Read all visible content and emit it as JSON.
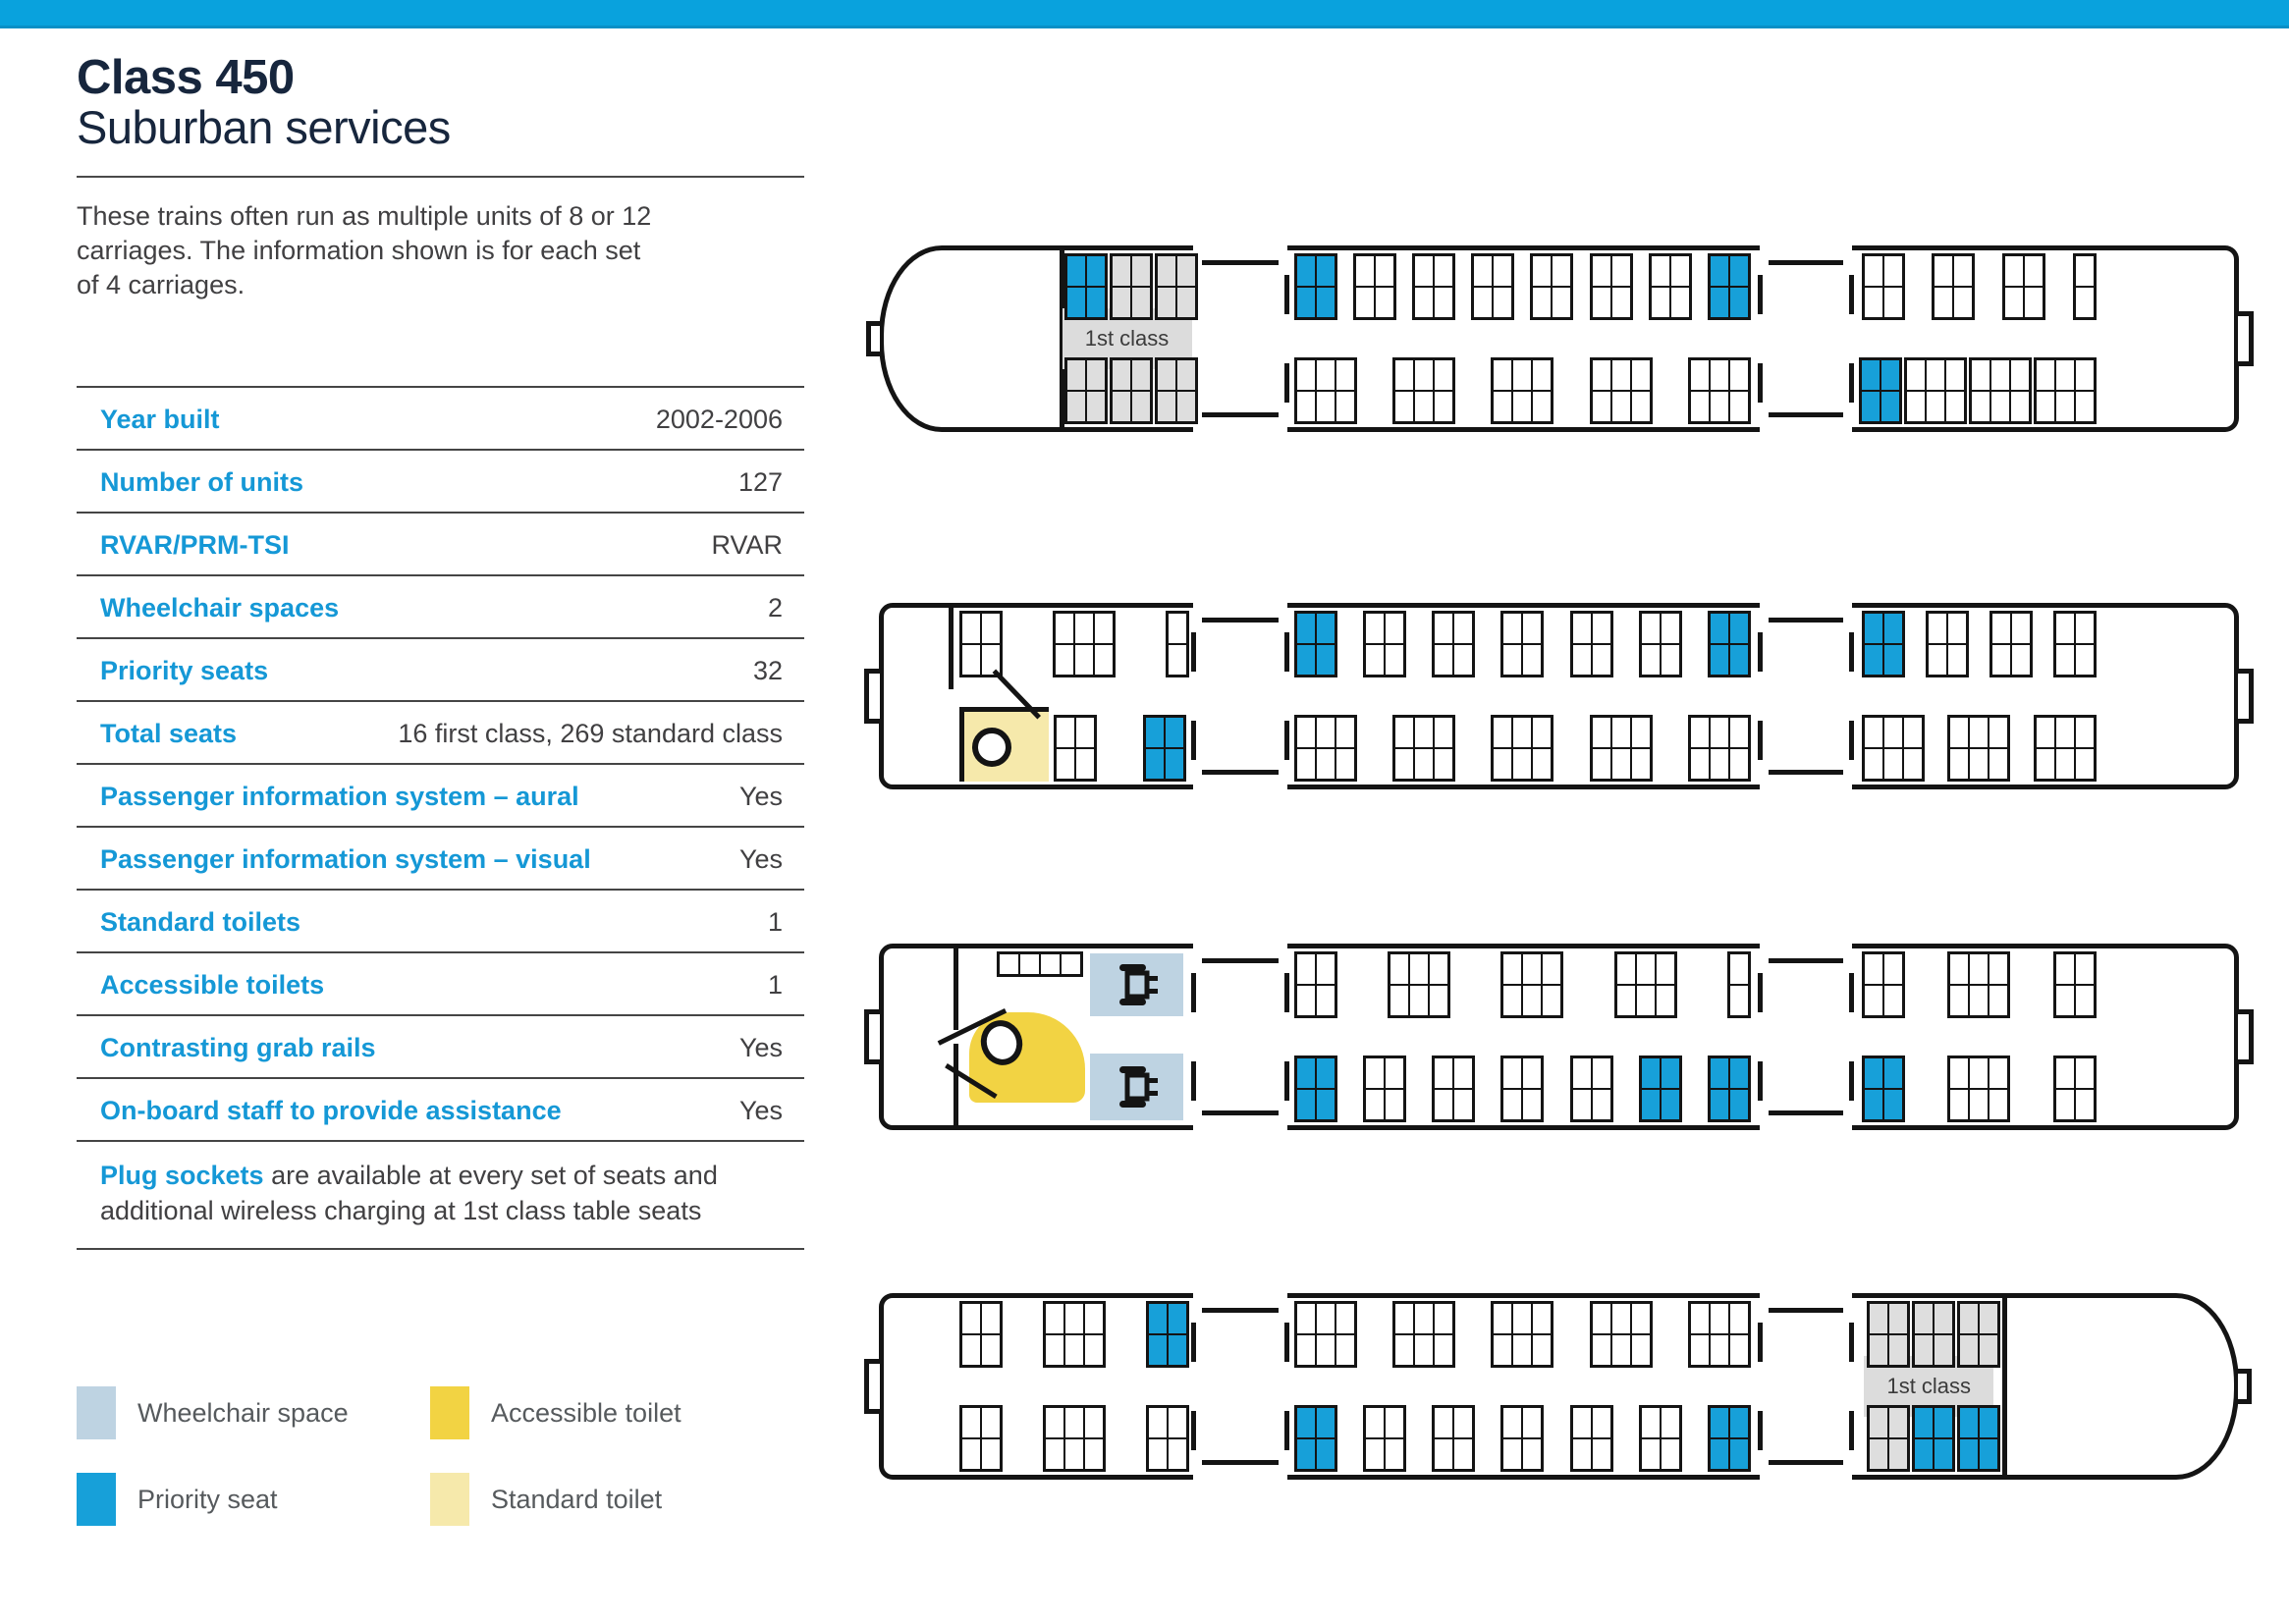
{
  "page": {
    "title_line1": "Class 450",
    "title_line2": "Suburban services",
    "intro": "These trains often run as multiple units of 8 or 12\ncarriages. The information shown is for each set\nof 4 carriages."
  },
  "table": {
    "rows": [
      {
        "label": "Year built",
        "value": "2002-2006"
      },
      {
        "label": "Number of units",
        "value": "127"
      },
      {
        "label": "RVAR/PRM-TSI",
        "value": "RVAR"
      },
      {
        "label": "Wheelchair spaces",
        "value": "2"
      },
      {
        "label": "Priority seats",
        "value": "32"
      },
      {
        "label": "Total seats",
        "value": "16 first class, 269 standard class"
      },
      {
        "label": "Passenger information system – aural",
        "value": "Yes"
      },
      {
        "label": "Passenger information system – visual",
        "value": "Yes"
      },
      {
        "label": "Standard toilets",
        "value": "1"
      },
      {
        "label": "Accessible toilets",
        "value": "1"
      },
      {
        "label": "Contrasting grab rails",
        "value": "Yes"
      },
      {
        "label": "On-board staff to provide assistance",
        "value": "Yes"
      }
    ],
    "note_lead": "Plug sockets",
    "note_rest": " are available at every set of seats and additional wireless charging at 1st class table seats"
  },
  "legend": [
    {
      "id": "wheelchair-space",
      "label": "Wheelchair space",
      "color": "#bed3e2"
    },
    {
      "id": "priority-seat",
      "label": "Priority seat",
      "color": "#17a0d9"
    },
    {
      "id": "accessible-toilet",
      "label": "Accessible toilet",
      "color": "#f2d343"
    },
    {
      "id": "standard-toilet",
      "label": "Standard toilet",
      "color": "#f6e9ab"
    }
  ],
  "colors": {
    "top_bar": "#09a2dd",
    "accent_cyan": "#1598d6",
    "title_navy": "#17263d",
    "priority_seat": "#17a0d9",
    "wheelchair_space": "#bed3e2",
    "accessible_toilet": "#f2d343",
    "standard_toilet": "#f6e9ab",
    "first_class_seat": "#dedede",
    "outline": "#141414"
  },
  "carriages": [
    {
      "name": "carriage-1",
      "cab": "left",
      "gangways": [
        "right"
      ],
      "label": {
        "text": "1st class",
        "x": 13.2,
        "w": 9.6
      },
      "walls": [
        {
          "x": 13.0,
          "span": "full"
        }
      ],
      "doors": [
        {
          "x": 22.9,
          "w": 7.0
        },
        {
          "x": 64.9,
          "w": 6.8
        }
      ],
      "bays": [
        {
          "row": "top",
          "x": 13.4,
          "x1": 22.6,
          "blocks": [
            "pri",
            "fc",
            "fc"
          ]
        },
        {
          "row": "top",
          "x": 30.4,
          "x1": 64.2,
          "blocks": [
            "pri",
            "std",
            "std",
            "std",
            "std",
            "std",
            "std",
            "pri"
          ]
        },
        {
          "row": "top",
          "x": 72.4,
          "x1": 89.8,
          "blocks": [
            "std",
            "std",
            "std",
            "std1"
          ]
        },
        {
          "row": "bottom",
          "x": 13.4,
          "x1": 22.6,
          "blocks": [
            "fc",
            "fc",
            "fc"
          ]
        },
        {
          "row": "bottom",
          "x": 30.4,
          "x1": 64.2,
          "blocks": [
            "std3",
            "std3",
            "std3",
            "std3",
            "std3"
          ]
        },
        {
          "row": "bottom",
          "x": 72.2,
          "x1": 89.8,
          "blocks": [
            "pri",
            "std3",
            "std3",
            "std3"
          ]
        }
      ],
      "features": []
    },
    {
      "name": "carriage-2",
      "cab": null,
      "gangways": [
        "left",
        "right"
      ],
      "label": null,
      "walls": [
        {
          "x": 4.8,
          "span": "top"
        }
      ],
      "doors": [
        {
          "x": 22.9,
          "w": 7.0
        },
        {
          "x": 64.9,
          "w": 6.8
        }
      ],
      "bays": [
        {
          "row": "top",
          "x": 5.6,
          "x1": 22.6,
          "blocks": [
            "std",
            "std3",
            "std1"
          ]
        },
        {
          "row": "top",
          "x": 30.4,
          "x1": 64.2,
          "blocks": [
            "pri",
            "std",
            "std",
            "std",
            "std",
            "std",
            "pri"
          ]
        },
        {
          "row": "top",
          "x": 72.4,
          "x1": 89.8,
          "blocks": [
            "pri",
            "std",
            "std",
            "std"
          ]
        },
        {
          "row": "bottom",
          "x": 12.6,
          "x1": 16.0,
          "blocks": [
            "std"
          ]
        },
        {
          "row": "bottom",
          "x": 19.2,
          "x1": 22.6,
          "blocks": [
            "pri"
          ]
        },
        {
          "row": "bottom",
          "x": 30.4,
          "x1": 64.2,
          "blocks": [
            "std3",
            "std3",
            "std3",
            "std3",
            "std3"
          ]
        },
        {
          "row": "bottom",
          "x": 72.4,
          "x1": 89.8,
          "blocks": [
            "std3",
            "std3",
            "std3"
          ]
        }
      ],
      "features": [
        {
          "kind": "toilet-std",
          "x": 5.6,
          "w": 6.6,
          "row": "bottom"
        }
      ]
    },
    {
      "name": "carriage-3",
      "cab": null,
      "gangways": [
        "left",
        "right"
      ],
      "label": null,
      "walls": [
        {
          "x": 5.2,
          "span": "top"
        },
        {
          "x": 5.2,
          "span": "bottom"
        }
      ],
      "doors": [
        {
          "x": 22.9,
          "w": 7.0
        },
        {
          "x": 64.9,
          "w": 6.8
        }
      ],
      "bays": [
        {
          "row": "top",
          "x": 30.4,
          "x1": 64.2,
          "blocks": [
            "std",
            "std3",
            "std3",
            "std3",
            "std1"
          ]
        },
        {
          "row": "top",
          "x": 72.4,
          "x1": 89.8,
          "blocks": [
            "std",
            "std3",
            "std"
          ]
        },
        {
          "row": "bottom",
          "x": 30.4,
          "x1": 64.2,
          "blocks": [
            "pri",
            "std",
            "std",
            "std",
            "std",
            "pri",
            "pri"
          ]
        },
        {
          "row": "bottom",
          "x": 72.4,
          "x1": 89.8,
          "blocks": [
            "pri",
            "std3",
            "std"
          ]
        }
      ],
      "features": [
        {
          "kind": "tipup",
          "x": 8.4,
          "w": 6.4,
          "row": "top",
          "cols": 4
        },
        {
          "kind": "wheelchair",
          "x": 15.3,
          "w": 6.9,
          "row": "top"
        },
        {
          "kind": "wheelchair",
          "x": 15.3,
          "w": 6.9,
          "row": "bottom"
        },
        {
          "kind": "toilet-acc",
          "x": 6.3,
          "w": 8.6,
          "row": "bottom"
        }
      ]
    },
    {
      "name": "carriage-4",
      "cab": "right",
      "gangways": [
        "left"
      ],
      "label": {
        "text": "1st class",
        "x": 72.6,
        "w": 9.6
      },
      "walls": [
        {
          "x": 82.8,
          "span": "full"
        }
      ],
      "doors": [
        {
          "x": 22.9,
          "w": 7.0
        },
        {
          "x": 64.9,
          "w": 6.8
        }
      ],
      "bays": [
        {
          "row": "top",
          "x": 5.6,
          "x1": 22.6,
          "blocks": [
            "std",
            "std3",
            "pri"
          ]
        },
        {
          "row": "top",
          "x": 30.4,
          "x1": 64.2,
          "blocks": [
            "std3",
            "std3",
            "std3",
            "std3",
            "std3"
          ]
        },
        {
          "row": "top",
          "x": 72.8,
          "x1": 82.2,
          "blocks": [
            "fc",
            "fc",
            "fc"
          ]
        },
        {
          "row": "bottom",
          "x": 5.6,
          "x1": 22.6,
          "blocks": [
            "std",
            "std3",
            "std"
          ]
        },
        {
          "row": "bottom",
          "x": 30.4,
          "x1": 64.2,
          "blocks": [
            "pri",
            "std",
            "std",
            "std",
            "std",
            "std",
            "pri"
          ]
        },
        {
          "row": "bottom",
          "x": 72.8,
          "x1": 82.2,
          "blocks": [
            "fc",
            "pri",
            "pri"
          ]
        }
      ],
      "features": []
    }
  ]
}
